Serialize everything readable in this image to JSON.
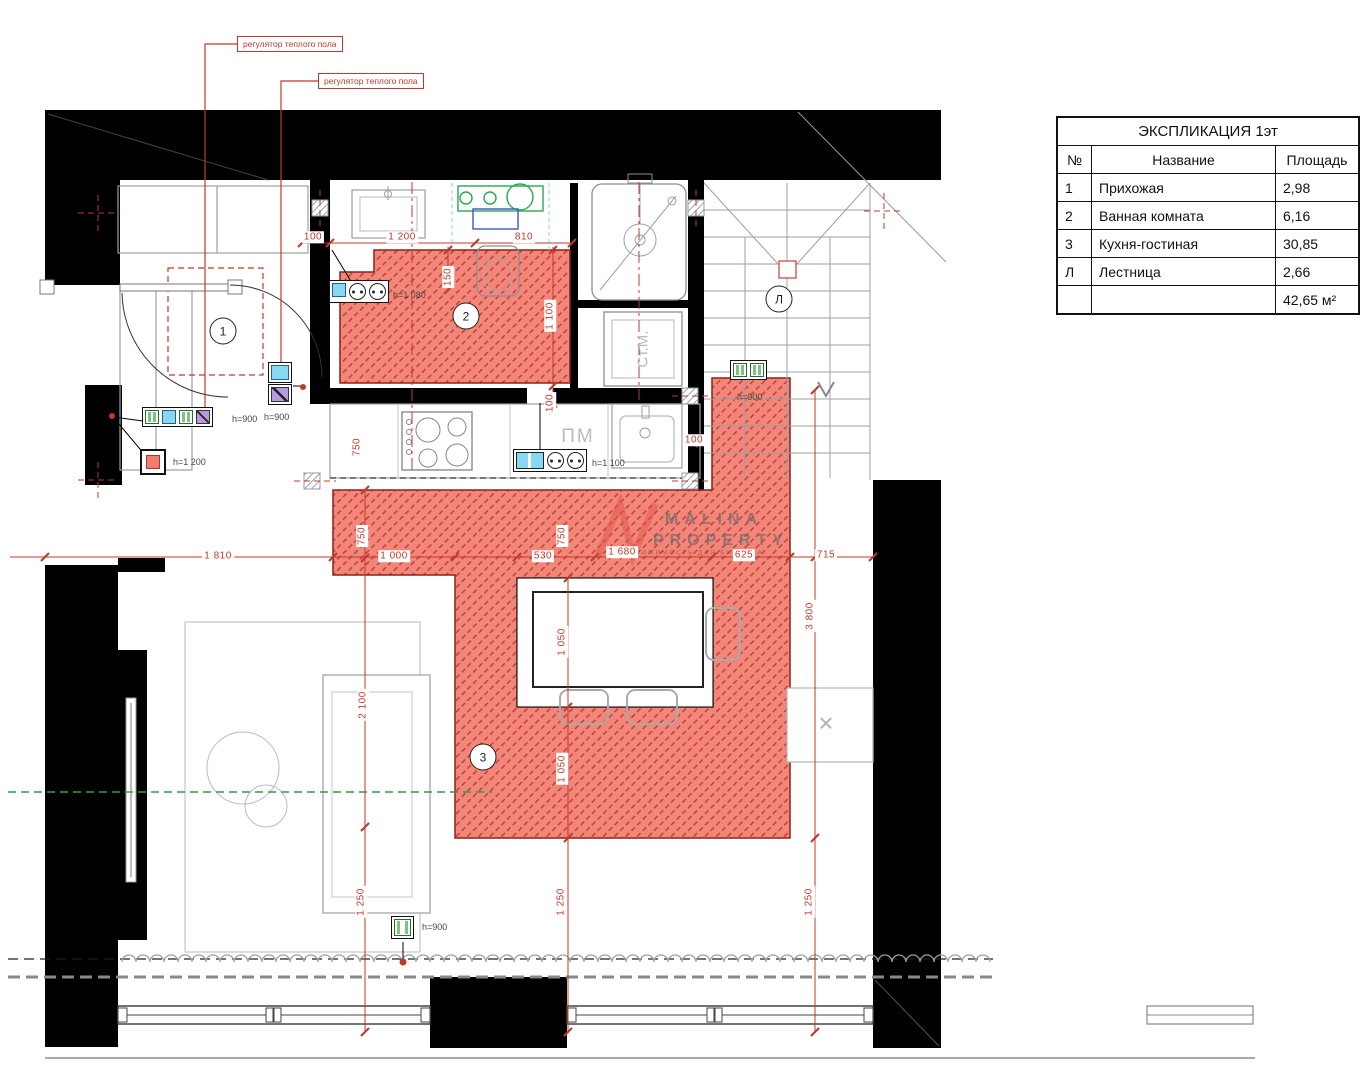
{
  "annotations": {
    "regulator1": "регулятор теплого пола",
    "regulator2": "регулятор теплого пола"
  },
  "room_markers": {
    "hall": "1",
    "bath": "2",
    "kitchen": "3",
    "stairs": "Л"
  },
  "appliances": {
    "washing_machine": "Ст.М.",
    "dishwasher": "ПМ",
    "cabinet_cross": "✕"
  },
  "heights": {
    "entry_group": "h=900",
    "entry_thermo": "h=1 200",
    "hall_pair": "h=900",
    "bath_sockets": "h=1 080",
    "kitchen_sockets": "h=1 100",
    "stairs_socket": "h=900",
    "window_socket": "h=900"
  },
  "dimensions": [
    "100",
    "1 200",
    "810",
    "150",
    "1 100",
    "100",
    "100",
    "750",
    "750",
    "750",
    "1 810",
    "1 000",
    "530",
    "1 680",
    "625",
    "715",
    "2 100",
    "1 050",
    "1 050",
    "3 800",
    "1 250",
    "1 250",
    "1 250"
  ],
  "watermark": {
    "line1": "MALINA",
    "line2": "PROPERTY",
    "tagline": "НЕДВИЖИМОСТЬ ДЛЯ БИЗНЕСА"
  },
  "explication": {
    "title": "ЭКСПЛИКАЦИЯ 1эт",
    "headers": {
      "num": "№",
      "name": "Название",
      "area": "Площадь"
    },
    "rows": [
      {
        "num": "1",
        "name": "Прихожая",
        "area": "2,98"
      },
      {
        "num": "2",
        "name": "Ванная комната",
        "area": "6,16"
      },
      {
        "num": "3",
        "name": "Кухня-гостиная",
        "area": "30,85"
      },
      {
        "num": "Л",
        "name": "Лестница",
        "area": "2,66"
      }
    ],
    "total": {
      "num": "",
      "name": "",
      "area": "42,65 м²"
    }
  },
  "colors": {
    "wall": "#000000",
    "heated_floor_fill": "#f2867b",
    "heated_floor_hatch": "#c03a2a",
    "dimension_red": "#c0392b",
    "socket_blue": "#86d9f2",
    "socket_green": "#7cc47f",
    "socket_purple": "#b49be0",
    "thermostat_red": "#ef7e70",
    "fixture_green": "#27a84d",
    "fixture_blue": "#3a57c9",
    "axis_green": "#2f9e44"
  }
}
